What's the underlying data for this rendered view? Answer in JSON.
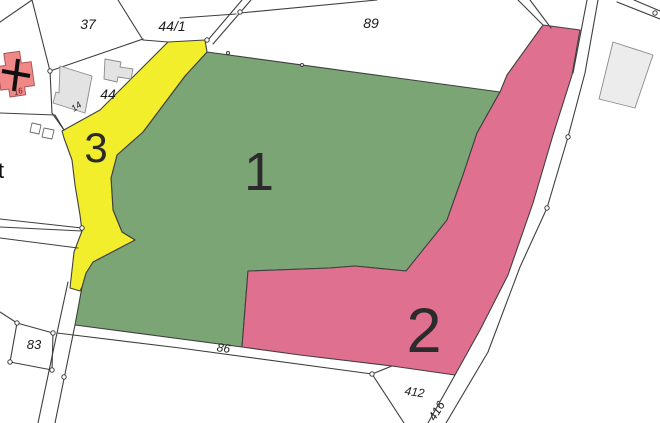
{
  "map": {
    "background": "#ffffff",
    "line_color": "#3f3f3f",
    "line_width": 1.1,
    "number_color": "#2b2b2b",
    "label_color": "#1c1c1c",
    "regions": [
      {
        "id": "1",
        "label": "1",
        "fill": "#7ca575",
        "points": "207,52 500,92 477,133 463,175 447,220 441,243 406,271 355,266 330,268 248,271 242,347 75,325 82,287 86,273 93,262 135,240 122,232 113,210 111,178 117,155 143,132 167,100 185,76",
        "label_x": 259,
        "label_y": 190,
        "label_size": 54
      },
      {
        "id": "2",
        "label": "2",
        "fill": "#e0708f",
        "points": "543,25 580,30 572,75 553,135 533,203 508,275 480,330 455,375 392,366 300,355 242,347 248,271 330,268 355,266 406,271 447,220 463,175 477,133 500,92 507,75",
        "label_x": 424,
        "label_y": 352,
        "label_size": 63
      },
      {
        "id": "3",
        "label": "3",
        "fill": "#f2ee2b",
        "points": "168,42 205,40 207,52 185,76 167,100 143,132 117,155 111,178 113,210 122,232 135,240 93,262 86,273 82,287 80,291 70,288 74,252 82,231 80,215 75,185 72,160 64,138 62,131 100,110 133,77",
        "label_x": 96,
        "label_y": 162,
        "label_size": 42
      }
    ],
    "boundary_lines": [
      {
        "points": "32,0 50,71"
      },
      {
        "points": "50,71 52,113 64,130"
      },
      {
        "points": "0,113 55,115 64,130"
      },
      {
        "points": "0,22 32,0"
      },
      {
        "points": "50,71 143,39"
      },
      {
        "points": "118,0 143,40"
      },
      {
        "points": "143,40 168,42"
      },
      {
        "points": "242,0 208,40"
      },
      {
        "points": "251,0 213,44"
      },
      {
        "points": "180,18 236,14"
      },
      {
        "points": "240,13 377,0"
      },
      {
        "points": "518,0 543,25"
      },
      {
        "points": "530,0 551,28"
      },
      {
        "points": "598,0 585,73 568,137 547,208 520,267 488,352 446,423"
      },
      {
        "points": "587,0 573,73"
      },
      {
        "points": "455,375 428,423"
      },
      {
        "points": "617,2 660,19"
      },
      {
        "points": "634,0 660,11"
      },
      {
        "points": "57,333 180,348 372,374"
      },
      {
        "points": "372,374 392,366"
      },
      {
        "points": "372,374 404,423"
      },
      {
        "points": "68,282 57,333 38,423"
      },
      {
        "points": "75,325 55,423"
      },
      {
        "points": "0,219 82,228"
      },
      {
        "points": "0,227 82,231"
      },
      {
        "points": "0,238 78,248"
      },
      {
        "points": "0,312 17,323"
      }
    ],
    "parcel_outlines": [
      {
        "id": "83",
        "points": "17,323 53,333 52,370 10,362"
      }
    ],
    "buildings": [
      {
        "id": "church",
        "fill": "#f08888",
        "stroke": "#a05050",
        "points": "3.8,53.5 19.6,51.3 21.3,63.1 31.2,61.7 34.5,85.5 24.6,86.9 25.7,94.8 9.9,97 8.8,89.1 0.8,90.2 -2.5,66.5 5.5,65.4"
      },
      {
        "id": "building-14",
        "fill": "#e3e3e3",
        "stroke": "#8a8a8a",
        "points": "60,66 92,76 85,113 53,103 56,92 59,93"
      },
      {
        "id": "outbuilding-44",
        "fill": "#e3e3e3",
        "stroke": "#8a8a8a",
        "points": "105,59 121,62 120,67 133,69 131,79 118,77 117,82 104,79"
      },
      {
        "id": "building-right",
        "fill": "#ececec",
        "stroke": "#8a8a8a",
        "points": "613,42 653,55 635,108 599,99"
      },
      {
        "id": "shed-a",
        "fill": "#ffffff",
        "stroke": "#6b6b6b",
        "points": "32,123 41,125 39,134 30,132"
      },
      {
        "id": "shed-b",
        "fill": "#ffffff",
        "stroke": "#6b6b6b",
        "points": "44,128 54,130 52,139 42,137"
      }
    ],
    "church_cross": {
      "color": "#101010",
      "width": 4,
      "lines": [
        {
          "points": "2,71 30,76"
        },
        {
          "points": "18,59 14,91"
        }
      ]
    },
    "survey_points": [
      {
        "x": 50,
        "y": 71
      },
      {
        "x": 240,
        "y": 12
      },
      {
        "x": 207,
        "y": 40
      },
      {
        "x": 82,
        "y": 228
      },
      {
        "x": 228,
        "y": 53,
        "r": 1.5
      },
      {
        "x": 302,
        "y": 65,
        "r": 1.5
      },
      {
        "x": 568,
        "y": 137
      },
      {
        "x": 547,
        "y": 208
      },
      {
        "x": 655,
        "y": 13
      },
      {
        "x": 372,
        "y": 374
      },
      {
        "x": 64,
        "y": 377
      },
      {
        "x": 17,
        "y": 323
      },
      {
        "x": 53,
        "y": 333
      },
      {
        "x": 52,
        "y": 370
      },
      {
        "x": 10,
        "y": 362
      }
    ],
    "parcel_labels": [
      {
        "text": "37",
        "x": 88,
        "y": 29,
        "size": 14
      },
      {
        "text": "44/1",
        "x": 172,
        "y": 31,
        "size": 14
      },
      {
        "text": "89",
        "x": 371,
        "y": 28,
        "size": 14
      },
      {
        "text": "44",
        "x": 108,
        "y": 99,
        "size": 14
      },
      {
        "text": "14",
        "x": 78,
        "y": 109,
        "size": 9,
        "rotate": -35
      },
      {
        "text": "16",
        "x": 19,
        "y": 94,
        "size": 8,
        "rotate": -18,
        "fill": "#5a1f1f"
      },
      {
        "text": "83",
        "x": 34,
        "y": 349,
        "size": 13
      },
      {
        "text": "86",
        "x": 223,
        "y": 352,
        "size": 12,
        "rotate": 8
      },
      {
        "text": "412",
        "x": 414,
        "y": 396,
        "size": 12,
        "rotate": 8
      },
      {
        "text": "416",
        "x": 440,
        "y": 413,
        "size": 12,
        "rotate": -58
      },
      {
        "text": "t",
        "x": -2,
        "y": 178,
        "size": 22,
        "italic": false,
        "anchor": "start",
        "fill": "#111111"
      }
    ]
  }
}
